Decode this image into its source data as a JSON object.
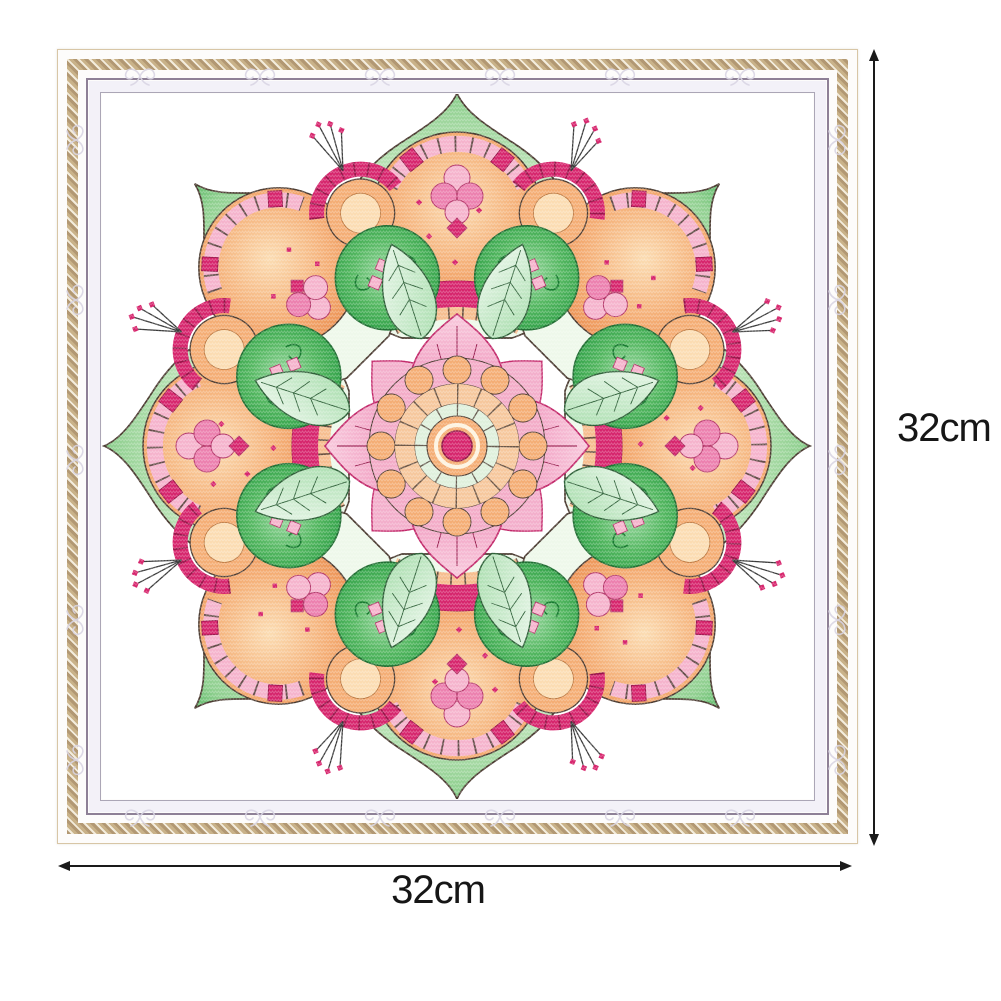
{
  "page": {
    "background": "#ffffff"
  },
  "annotations": {
    "width_label": "32cm",
    "height_label": "32cm",
    "arrow_color": "#1a1a1a",
    "label_color": "#161616"
  },
  "frame": {
    "outer_line": "#d8c6a6",
    "face": "#fdfcfb",
    "gold_band": "#c9b289",
    "gold_band_light": "#f3ecdc",
    "gold_band_dark": "#b29873",
    "purple_line": "#8e8096",
    "inner_band": "#f3f1f8",
    "grey_line": "#aba6b6",
    "flourish": "#d9d5e3"
  },
  "fabric": {
    "color": "#ffffff"
  },
  "mandala": {
    "palette": {
      "green_light": "#eef8ea",
      "green_mid": "#8ecf8e",
      "green": "#57b763",
      "green_deep": "#2a9d43",
      "swirl_green": "#157a2e",
      "mint": "#dff0dc",
      "leaf_edge": "#2c5e36",
      "orange_light": "#fbdcb2",
      "orange": "#f4ad74",
      "orange_deep": "#eb8f50",
      "peach_line": "#b5713a",
      "pink_light": "#f5b3cc",
      "pink": "#ec7fae",
      "pink_deep": "#c2286a",
      "magenta": "#d6246c",
      "magenta_dark": "#8f1244",
      "cream": "#fdf3e0",
      "outline": "#4a3a30",
      "stamen": "#3a3a3a"
    }
  }
}
